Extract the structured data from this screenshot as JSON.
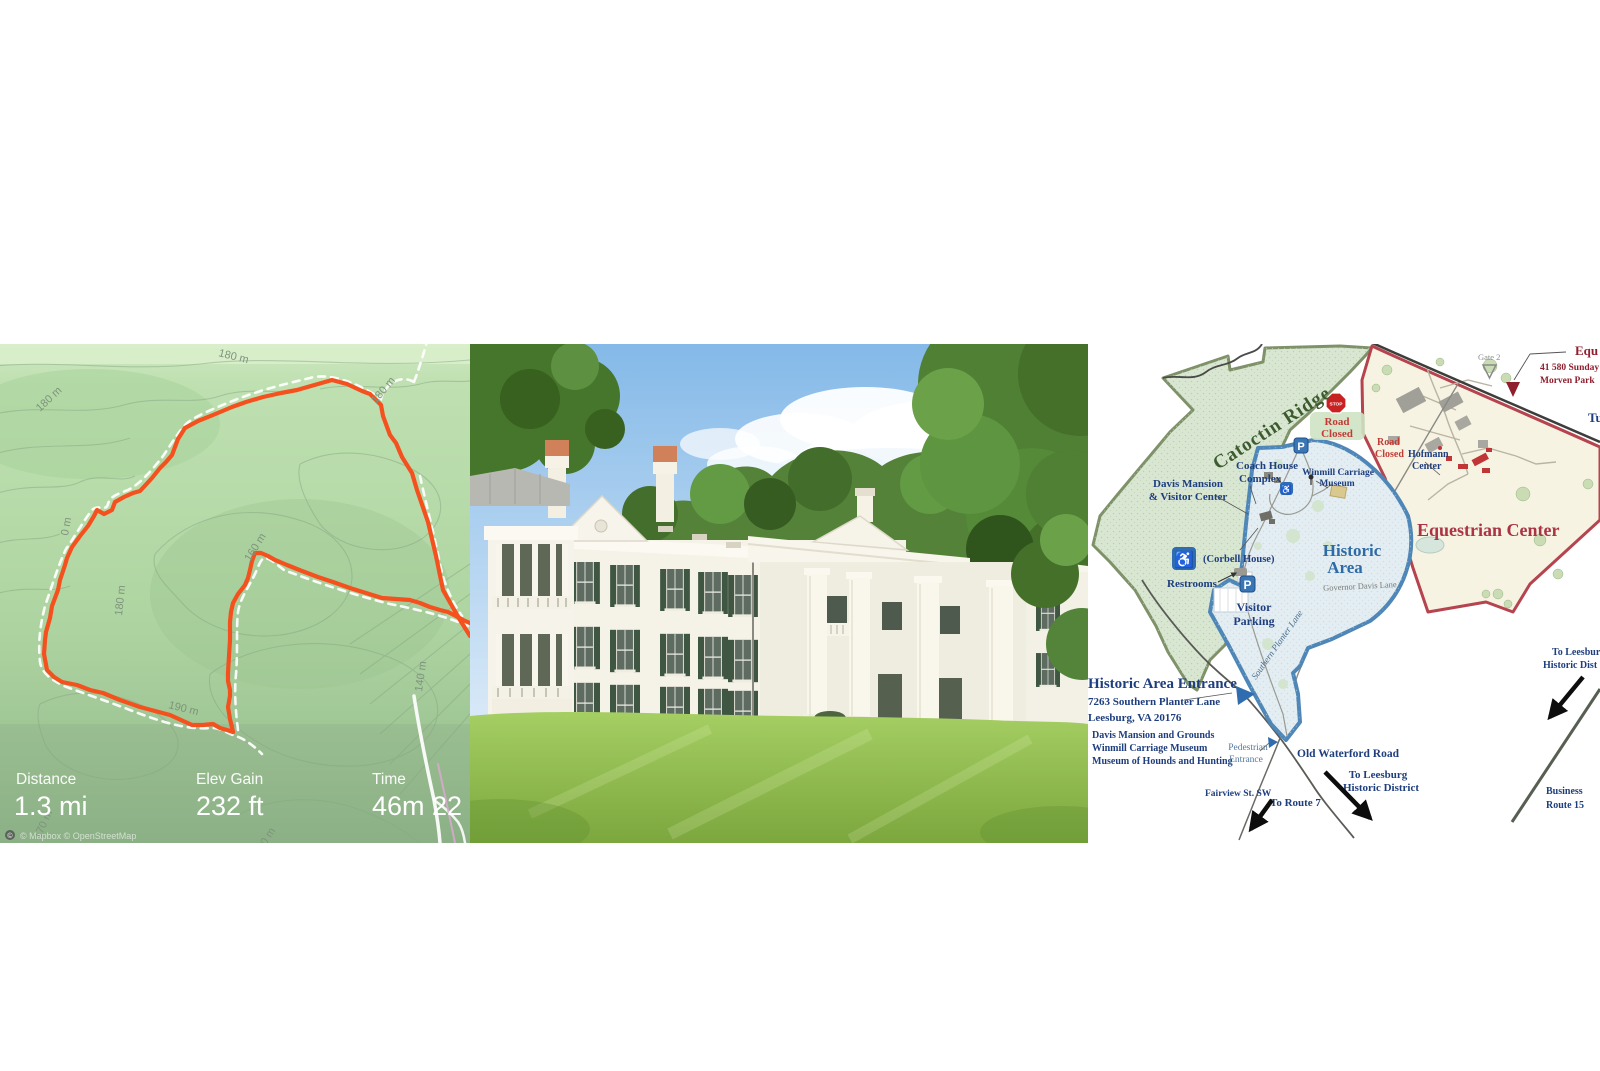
{
  "left_map": {
    "stats": {
      "distance_label": "Distance",
      "distance_value": "1.3 mi",
      "elev_label": "Elev Gain",
      "elev_value": "232 ft",
      "time_label": "Time",
      "time_value": "46m 22"
    },
    "contour_labels": [
      {
        "text": "180 m"
      },
      {
        "text": "180 m"
      },
      {
        "text": "180 m"
      },
      {
        "text": "160 m"
      },
      {
        "text": "180 m"
      },
      {
        "text": "0 m"
      },
      {
        "text": "190 m"
      },
      {
        "text": "140 m"
      },
      {
        "text": "170 m"
      },
      {
        "text": "0 m"
      }
    ],
    "attribution_icon": "©",
    "attribution": "© Mapbox © OpenStreetMap",
    "colors": {
      "route": "#f4511f",
      "trail": "#ffffff",
      "background": "#b4d9a8"
    }
  },
  "right_map": {
    "areas": {
      "catoctin": "Catoctin Ridge",
      "historic_1": "Historic",
      "historic_2": "Area",
      "equestrian": "Equestrian Center"
    },
    "labels": {
      "gate2": "Gate 2",
      "equ_trunc": "Equ",
      "sunday_trunc": "41 580 Sunday",
      "morven_trunc": "Morven Park",
      "tu_trunc": "Tu",
      "stop": "STOP",
      "road_closed1_a": "Road",
      "road_closed1_b": "Closed",
      "road_closed2_a": "Road",
      "road_closed2_b": "Closed",
      "hofmann_a": "Hofmann",
      "hofmann_b": "Center",
      "coach_a": "Coach House",
      "coach_b": "Complex",
      "davis_a": "Davis Mansion",
      "davis_b": "& Visitor Center",
      "winmill_a": "Winmill Carriage",
      "winmill_b": "Museum",
      "corbell": "(Corbell House)",
      "restrooms": "Restrooms",
      "governor": "Governor Davis Lane",
      "parking_a": "Visitor",
      "parking_b": "Parking",
      "p_letter": "P",
      "wheelchair": "♿",
      "southern_rot": "Southern Planter Lane",
      "entrance_title": "Historic Area Entrance",
      "entrance_addr1": "7263 Southern Planter Lane",
      "entrance_addr2": "Leesburg, VA 20176",
      "entrance_line1": "Davis Mansion and Grounds",
      "entrance_line2": "Winmill Carriage Museum",
      "entrance_line3": "Museum of Hounds and Hunting",
      "pedestrian_a": "Pedestrian",
      "pedestrian_b": "Entrance",
      "old_waterford": "Old Waterford Road",
      "leesburg_bottom_a": "To Leesburg",
      "leesburg_bottom_b": "Historic District",
      "fairview": "Fairview St. SW",
      "route7": "To Route 7",
      "leesburg_right_a": "To Leesbur",
      "leesburg_right_b": "Historic Dist",
      "business_a": "Business",
      "business_b": "Route 15"
    },
    "colors": {
      "navy": "#1e3e7e",
      "red": "#c23a34",
      "dark_red": "#a23043",
      "green_area": "#d9e7d2",
      "blue_area": "#e3edf2",
      "cream_area": "#f7f3e3"
    }
  }
}
